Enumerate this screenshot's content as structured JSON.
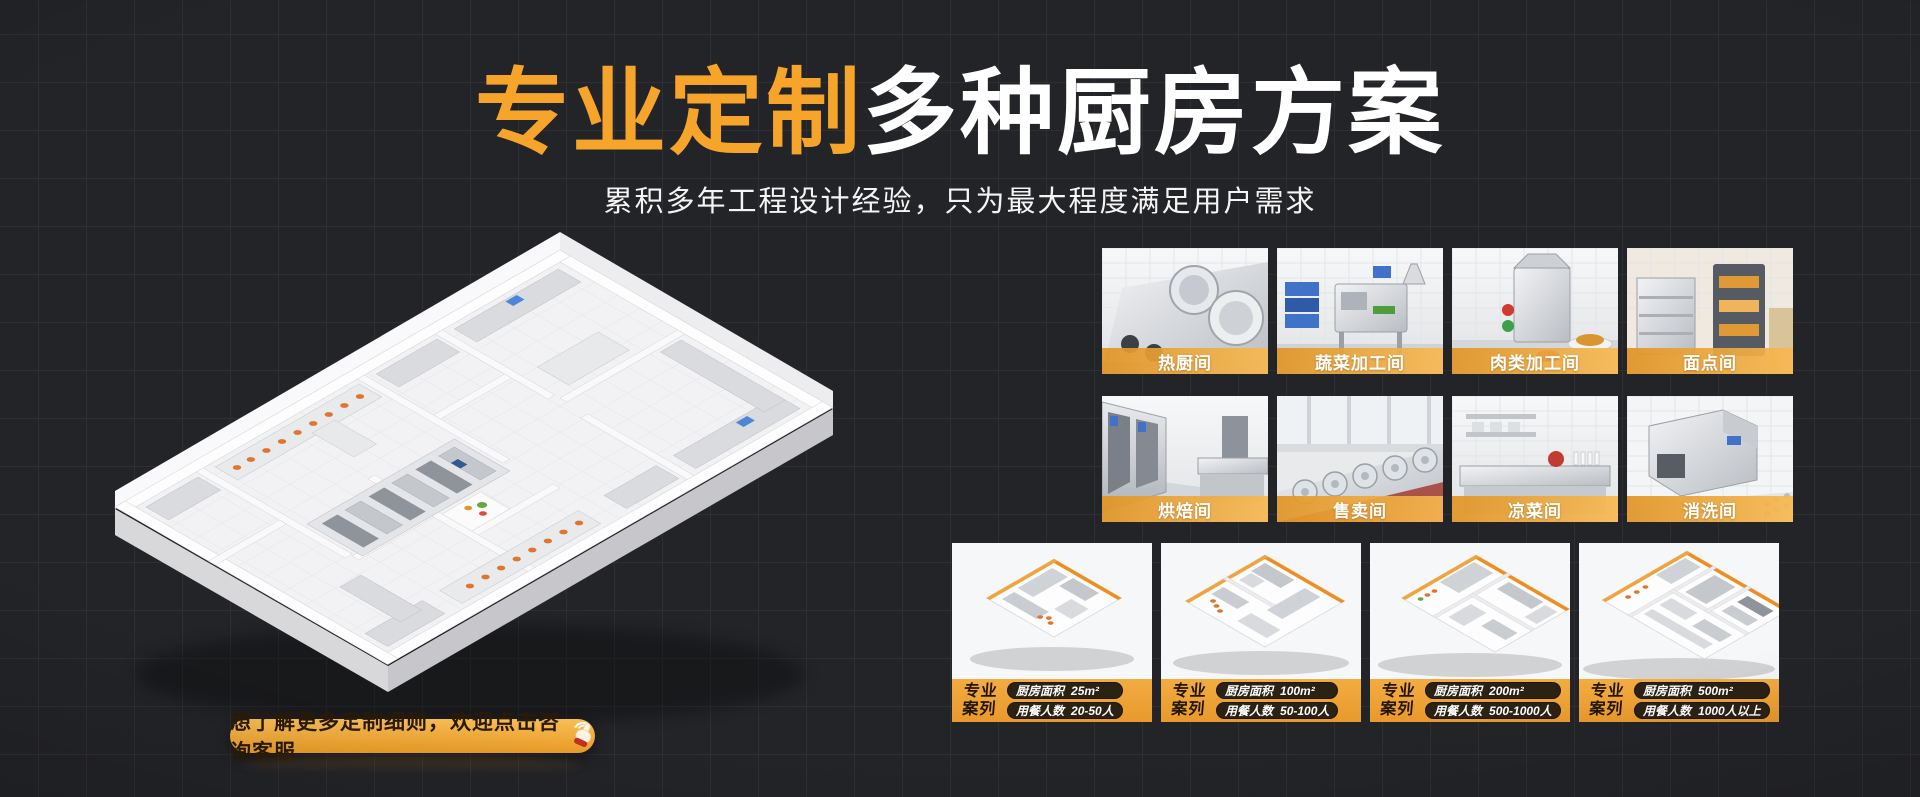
{
  "header": {
    "title_highlight": "专业定制",
    "title_rest": "多种厨房方案",
    "subtitle": "累积多年工程设计经验，只为最大程度满足用户需求"
  },
  "rooms": [
    {
      "label": "热厨间"
    },
    {
      "label": "蔬菜加工间"
    },
    {
      "label": "肉类加工间"
    },
    {
      "label": "面点间"
    },
    {
      "label": "烘焙间"
    },
    {
      "label": "售卖间"
    },
    {
      "label": "凉菜间"
    },
    {
      "label": "消洗间"
    }
  ],
  "cases": {
    "badge_top": "专业",
    "badge_bottom": "案列",
    "items": [
      {
        "area_label": "厨房面积",
        "area_value": "25m²",
        "diners_label": "用餐人数",
        "diners_value": "20-50人"
      },
      {
        "area_label": "厨房面积",
        "area_value": "100m²",
        "diners_label": "用餐人数",
        "diners_value": "50-100人"
      },
      {
        "area_label": "厨房面积",
        "area_value": "200m²",
        "diners_label": "用餐人数",
        "diners_value": "500-1000人"
      },
      {
        "area_label": "厨房面积",
        "area_value": "500m²",
        "diners_label": "用餐人数",
        "diners_value": "1000人以上"
      }
    ]
  },
  "cta": {
    "label": "想了解更多定制细则，欢迎点击咨询客服"
  },
  "colors": {
    "background": "#232428",
    "grid_line": "#2e2f33",
    "accent_orange": "#F5A42B",
    "title_highlight": "#F7A52A",
    "title_rest": "#FFFFFF",
    "room_label_bar": "#F0A83B",
    "case_bar": "#EC9F33",
    "pill_background": "#2B2214",
    "cta_text": "#2A1A08"
  }
}
